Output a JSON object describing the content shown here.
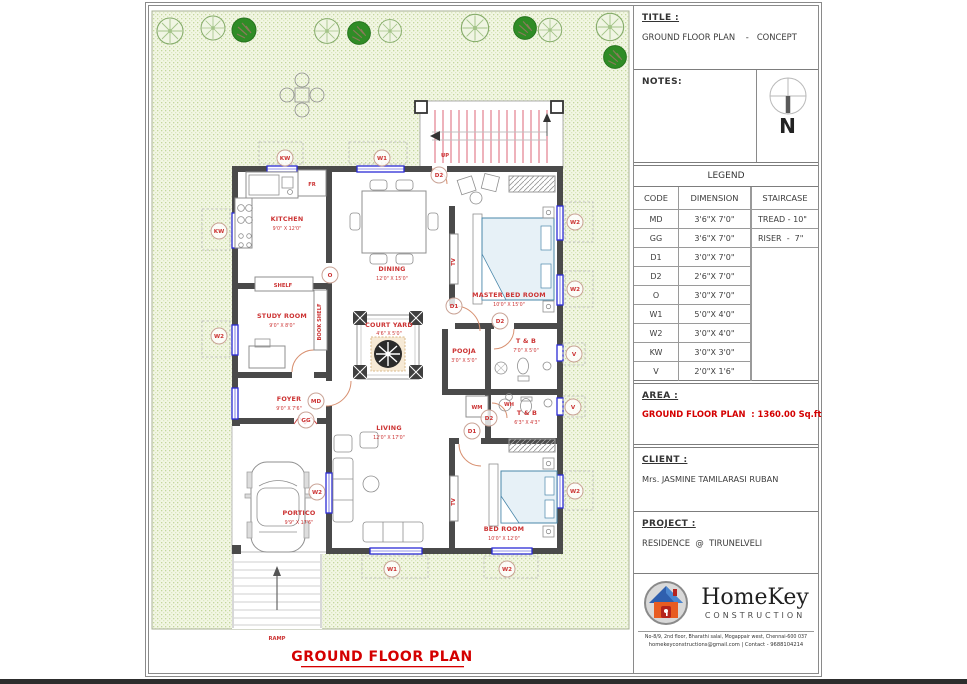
{
  "title_block": {
    "title": {
      "label": "TITLE :",
      "value": "GROUND FLOOR PLAN    -   CONCEPT"
    },
    "notes": {
      "label": "NOTES:",
      "north": "N"
    },
    "legend": {
      "header": "LEGEND",
      "col_code": "CODE",
      "col_dimension": "DIMENSION",
      "col_staircase": "STAIRCASE",
      "rows": [
        {
          "code": "MD",
          "dim": "3'6\"X 7'0\"",
          "stair": "TREAD - 10\""
        },
        {
          "code": "GG",
          "dim": "3'6\"X 7'0\"",
          "stair": "RISER  -  7\""
        },
        {
          "code": "D1",
          "dim": "3'0\"X 7'0\"",
          "stair": ""
        },
        {
          "code": "D2",
          "dim": "2'6\"X 7'0\"",
          "stair": ""
        },
        {
          "code": "O",
          "dim": "3'0\"X 7'0\"",
          "stair": ""
        },
        {
          "code": "W1",
          "dim": "5'0\"X 4'0\"",
          "stair": ""
        },
        {
          "code": "W2",
          "dim": "3'0\"X 4'0\"",
          "stair": ""
        },
        {
          "code": "KW",
          "dim": "3'0\"X 3'0\"",
          "stair": ""
        },
        {
          "code": "V",
          "dim": "2'0\"X 1'6\"",
          "stair": ""
        }
      ]
    },
    "area": {
      "label": "AREA :",
      "value": "GROUND FLOOR PLAN  : 1360.00 Sq.ft"
    },
    "client": {
      "label": "CLIENT :",
      "value": "Mrs. JASMINE TAMILARASI RUBAN"
    },
    "project": {
      "label": "PROJECT :",
      "value": "RESIDENCE  @  TIRUNELVELI"
    },
    "logo": {
      "name": "HomeKey",
      "tagline": "CONSTRUCTION",
      "address1": "No-8/9, 2nd floor, Bharathi salai, Mogappair west, Chennai-600 037",
      "address2": "homekeyconstructions@gmail.com | Contact - 9688104214"
    }
  },
  "plan": {
    "caption": "GROUND FLOOR PLAN",
    "rooms": [
      {
        "name": "KITCHEN",
        "dim": "9'0\" X 12'0\""
      },
      {
        "name": "DINING",
        "dim": "12'0\" X 15'0\""
      },
      {
        "name": "MASTER BED ROOM",
        "dim": "10'0\" X 15'0\""
      },
      {
        "name": "STUDY ROOM",
        "dim": "9'0\" X 8'0\""
      },
      {
        "name": "COURT YARD",
        "dim": "4'6\" X 5'0\""
      },
      {
        "name": "POOJA",
        "dim": "3'0\" X 5'0\""
      },
      {
        "name": "T & B",
        "dim": "7'0\" X 5'0\""
      },
      {
        "name": "FOYER",
        "dim": "9'0\" X 7'6\""
      },
      {
        "name": "T & B",
        "dim": "6'3\" X 4'3\""
      },
      {
        "name": "LIVING",
        "dim": "12'0\" X 17'0\""
      },
      {
        "name": "PORTICO",
        "dim": "9'9\" X 17'6\""
      },
      {
        "name": "BED ROOM",
        "dim": "10'0\" X 12'0\""
      }
    ],
    "texts": {
      "shelf": "SHELF",
      "fr": "FR",
      "book_shelf": "BOOK SHELF",
      "up": "UP",
      "ramp": "RAMP",
      "tv_master": "TV",
      "tv_bed": "TV",
      "wm": "WM",
      "wh": "WH"
    },
    "markers": [
      "KW",
      "W1",
      "D2",
      "KW",
      "W2",
      "O",
      "D1",
      "D2",
      "W2",
      "W2",
      "V",
      "V",
      "W2",
      "MD",
      "GG",
      "D2",
      "D1",
      "W2",
      "W1",
      "W2"
    ]
  },
  "colors": {
    "accent_red": "#cc3333",
    "window_blue": "#2b2bd6",
    "wall_gray": "#4a4a4a",
    "site_green": "#f2f6e4"
  }
}
